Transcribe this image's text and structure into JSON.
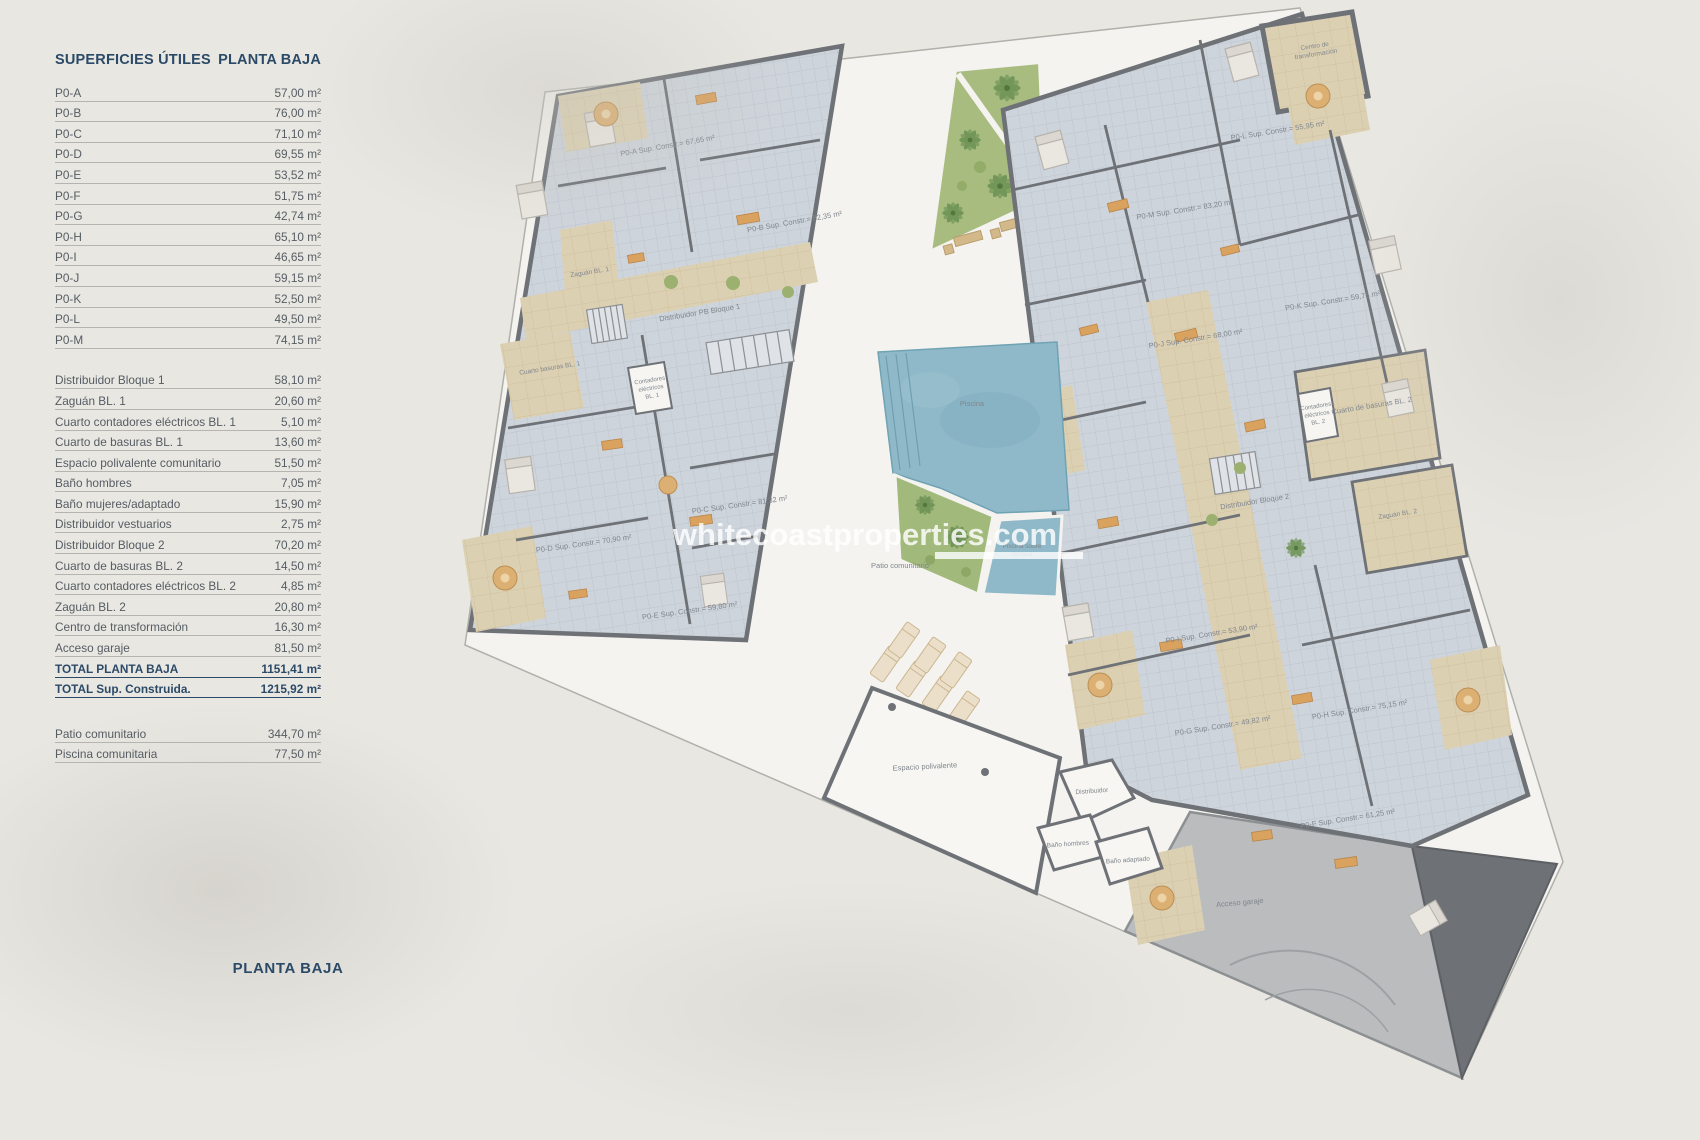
{
  "table": {
    "header": {
      "left": "SUPERFICIES ÚTILES",
      "right": "PLANTA BAJA"
    },
    "groups": [
      {
        "rows": [
          {
            "label": "P0-A",
            "value": "57,00 m²"
          },
          {
            "label": "P0-B",
            "value": "76,00 m²"
          },
          {
            "label": "P0-C",
            "value": "71,10 m²"
          },
          {
            "label": "P0-D",
            "value": "69,55 m²"
          },
          {
            "label": "P0-E",
            "value": "53,52 m²"
          },
          {
            "label": "P0-F",
            "value": "51,75 m²"
          },
          {
            "label": "P0-G",
            "value": "42,74 m²"
          },
          {
            "label": "P0-H",
            "value": "65,10 m²"
          },
          {
            "label": "P0-I",
            "value": "46,65 m²"
          },
          {
            "label": "P0-J",
            "value": "59,15 m²"
          },
          {
            "label": "P0-K",
            "value": "52,50 m²"
          },
          {
            "label": "P0-L",
            "value": "49,50 m²"
          },
          {
            "label": "P0-M",
            "value": "74,15 m²"
          }
        ]
      },
      {
        "rows": [
          {
            "label": "Distribuidor Bloque 1",
            "value": "58,10 m²"
          },
          {
            "label": "Zaguán BL. 1",
            "value": "20,60 m²"
          },
          {
            "label": "Cuarto contadores eléctricos BL. 1",
            "value": "5,10 m²"
          },
          {
            "label": "Cuarto de basuras BL. 1",
            "value": "13,60 m²"
          },
          {
            "label": "Espacio polivalente comunitario",
            "value": "51,50 m²"
          },
          {
            "label": "Baño hombres",
            "value": "7,05 m²"
          },
          {
            "label": "Baño mujeres/adaptado",
            "value": "15,90 m²"
          },
          {
            "label": "Distribuidor vestuarios",
            "value": "2,75 m²"
          },
          {
            "label": "Distribuidor Bloque 2",
            "value": "70,20 m²"
          },
          {
            "label": "Cuarto de basuras BL. 2",
            "value": "14,50 m²"
          },
          {
            "label": "Cuarto contadores eléctricos BL. 2",
            "value": "4,85 m²"
          },
          {
            "label": "Zaguán BL. 2",
            "value": "20,80 m²"
          },
          {
            "label": "Centro de transformación",
            "value": "16,30 m²"
          },
          {
            "label": "Acceso garaje",
            "value": "81,50 m²"
          },
          {
            "label": "TOTAL PLANTA BAJA",
            "value": "1151,41 m²",
            "total": true
          },
          {
            "label": "TOTAL Sup. Construida.",
            "value": "1215,92 m²",
            "total": true
          }
        ]
      },
      {
        "rows": [
          {
            "label": "Patio comunitario",
            "value": "344,70 m²"
          },
          {
            "label": "Piscina comunitaria",
            "value": "77,50 m²"
          }
        ]
      }
    ]
  },
  "footer": {
    "label": "PLANTA BAJA"
  },
  "plan": {
    "watermark": "whitecoastproperties.com",
    "colors": {
      "wall": "#6e7277",
      "tile": "#ced4db",
      "corridor": "#dcd0b3",
      "pool": "#8fb9c8",
      "green": "#a2b97c",
      "patio": "#f4f3ef",
      "ramp": "#babcbe",
      "accent": "#d9a25f",
      "table_blue": "#2b4a68"
    },
    "labels": [
      {
        "lines": [
          "P0-A Sup. Constr.= 67,65 m²"
        ],
        "x": 668,
        "y": 148,
        "r": -10
      },
      {
        "lines": [
          "P0-B Sup. Constr.= 82,35 m²"
        ],
        "x": 795,
        "y": 224,
        "r": -10
      },
      {
        "lines": [
          "P0-C Sup. Constr.= 81,32 m²"
        ],
        "x": 740,
        "y": 507,
        "r": -8
      },
      {
        "lines": [
          "P0-D Sup. Constr.= 70,90 m²"
        ],
        "x": 584,
        "y": 546,
        "r": -8
      },
      {
        "lines": [
          "P0-E Sup. Constr.= 59,80 m²"
        ],
        "x": 690,
        "y": 613,
        "r": -8
      },
      {
        "lines": [
          "P0-L Sup. Constr.= 55,95 m²"
        ],
        "x": 1278,
        "y": 133,
        "r": -9
      },
      {
        "lines": [
          "P0-M Sup. Constr.= 83,20 m²"
        ],
        "x": 1185,
        "y": 212,
        "r": -9
      },
      {
        "lines": [
          "P0-K Sup. Constr.= 59,75 m²"
        ],
        "x": 1333,
        "y": 303,
        "r": -9
      },
      {
        "lines": [
          "P0-J Sup. Constr.= 68,00 m²"
        ],
        "x": 1196,
        "y": 341,
        "r": -9
      },
      {
        "lines": [
          "P0-I Sup. Constr.= 53,90 m²"
        ],
        "x": 1212,
        "y": 636,
        "r": -9
      },
      {
        "lines": [
          "P0-G Sup. Constr.= 49,82 m²"
        ],
        "x": 1223,
        "y": 728,
        "r": -9
      },
      {
        "lines": [
          "P0-H Sup. Constr.= 75,15 m²"
        ],
        "x": 1360,
        "y": 712,
        "r": -9
      },
      {
        "lines": [
          "P0-F Sup. Constr.= 61,25 m²"
        ],
        "x": 1348,
        "y": 821,
        "r": -9
      },
      {
        "lines": [
          "Zaguán BL. 1"
        ],
        "x": 590,
        "y": 274,
        "r": -9,
        "s": 6.5
      },
      {
        "lines": [
          "Distribuidor PB Bloque 1"
        ],
        "x": 700,
        "y": 315,
        "r": -9
      },
      {
        "lines": [
          "Cuarto basuras BL. 1"
        ],
        "x": 550,
        "y": 370,
        "r": -9,
        "s": 6.5
      },
      {
        "lines": [
          "Contadores",
          "eléctricos",
          "BL. 1"
        ],
        "x": 650,
        "y": 382,
        "r": -9,
        "s": 6
      },
      {
        "lines": [
          "Espacio polivalente"
        ],
        "x": 925,
        "y": 769,
        "r": -3
      },
      {
        "lines": [
          "Distribuidor"
        ],
        "x": 1092,
        "y": 793,
        "r": -4,
        "s": 6.5
      },
      {
        "lines": [
          "Baño hombres"
        ],
        "x": 1068,
        "y": 846,
        "r": -4,
        "s": 6.5
      },
      {
        "lines": [
          "Baño adaptado"
        ],
        "x": 1128,
        "y": 862,
        "r": -4,
        "s": 6.5
      },
      {
        "lines": [
          "Piscina"
        ],
        "x": 972,
        "y": 406,
        "r": 0
      },
      {
        "lines": [
          "Piscina sobre",
          "terraza"
        ],
        "x": 1022,
        "y": 548,
        "r": 0,
        "s": 6.5
      },
      {
        "lines": [
          "Patio comunitario"
        ],
        "x": 900,
        "y": 568,
        "r": 0
      },
      {
        "lines": [
          "Acceso garaje"
        ],
        "x": 1240,
        "y": 905,
        "r": -5
      },
      {
        "lines": [
          "Centro de",
          "transformación"
        ],
        "x": 1315,
        "y": 48,
        "r": -9,
        "s": 6.5
      },
      {
        "lines": [
          "Distribuidor Bloque 2"
        ],
        "x": 1255,
        "y": 504,
        "r": -9
      },
      {
        "lines": [
          "Cuarto de basuras BL. 2"
        ],
        "x": 1372,
        "y": 408,
        "r": -9
      },
      {
        "lines": [
          "Contadores",
          "eléctricos",
          "BL. 2"
        ],
        "x": 1316,
        "y": 408,
        "r": -9,
        "s": 6
      },
      {
        "lines": [
          "Zaguán BL. 2"
        ],
        "x": 1398,
        "y": 516,
        "r": -9,
        "s": 6.5
      }
    ]
  }
}
